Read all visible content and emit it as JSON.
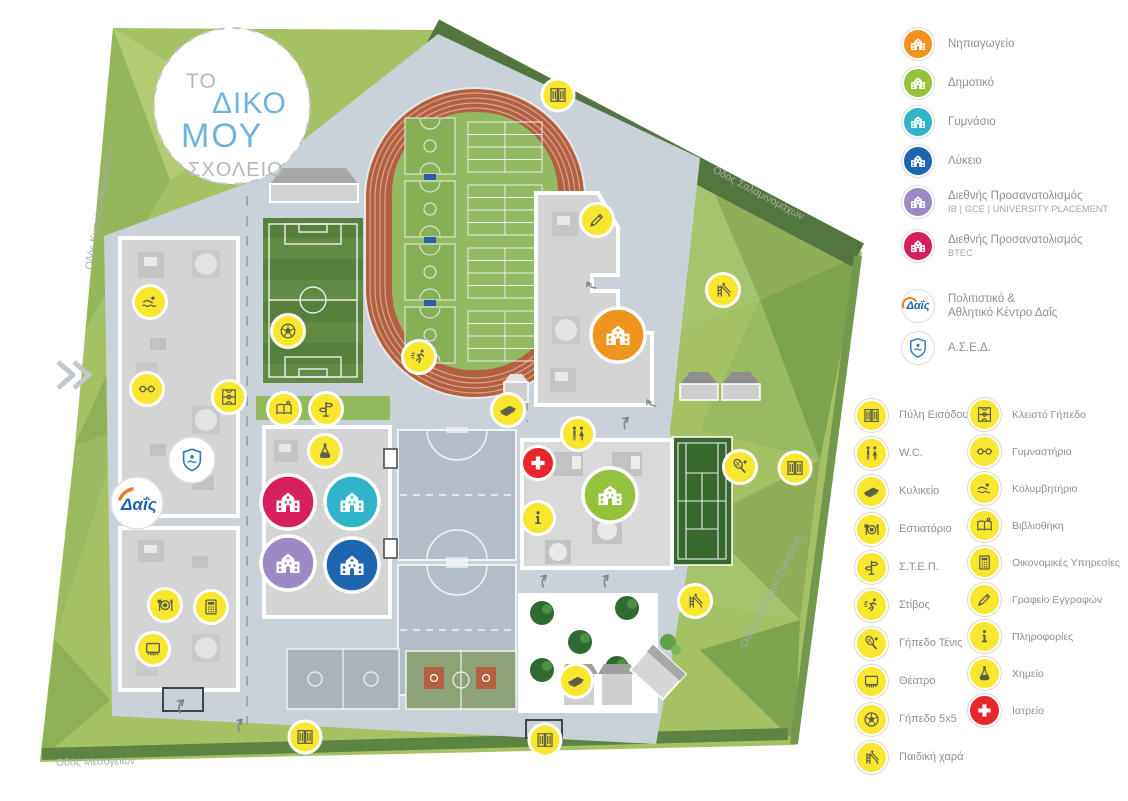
{
  "logo": {
    "word1": "ΤΟ",
    "word2": "ΔΙΚΟ",
    "word3": "ΜΟΥ",
    "word4": "ΣΧΟΛΕΙΟ"
  },
  "brand": {
    "dais": "Δαΐς"
  },
  "streets": {
    "left": "Οδός Κυπρίων Αγωνιστών",
    "top_right": "Οδός Σαλαμινομάχων",
    "right": "Οδός Ναυάρχου Σακτούρη",
    "bottom": "Οδός Μεσογείων"
  },
  "legend_schools": {
    "items": [
      {
        "label": "Νηπιαγωγείο",
        "color": "#f0941f",
        "icon": "school-building-icon"
      },
      {
        "label": "Δημοτικό",
        "color": "#96c13d",
        "icon": "school-building-icon"
      },
      {
        "label": "Γυμνάσιο",
        "color": "#2fb4c9",
        "icon": "school-building-icon"
      },
      {
        "label": "Λύκειο",
        "color": "#1d65af",
        "icon": "school-building-icon"
      },
      {
        "label": "Διεθνής Προσανατολισμός",
        "sub": "IB | GCE | UNIVERSITY PLACEMENT",
        "color": "#9c89c6",
        "icon": "school-building-icon"
      },
      {
        "label": "Διεθνής Προσανατολισμός",
        "sub": "BTEC",
        "color": "#d51f5e",
        "icon": "school-building-icon"
      }
    ],
    "extra": [
      {
        "label_line1": "Πολιτιστικό &",
        "label_line2": "Αθλητικό Κέντρο Δαΐς",
        "icon": "dais-logo"
      },
      {
        "label": "Α.Σ.Ε.Δ.",
        "icon": "ased-shield-icon"
      }
    ]
  },
  "legend_facilities": {
    "left": [
      {
        "label": "Πύλη Εισόδου",
        "icon": "door-icon"
      },
      {
        "label": "W.C.",
        "icon": "wc-icon"
      },
      {
        "label": "Κυλικείο",
        "icon": "sandwich-icon"
      },
      {
        "label": "Εστιατόριο",
        "icon": "restaurant-icon"
      },
      {
        "label": "Σ.Τ.Ε.Π.",
        "icon": "signpost-icon"
      },
      {
        "label": "Στίβος",
        "icon": "runner-icon"
      },
      {
        "label": "Γήπεδο Τένις",
        "icon": "tennis-racket-icon"
      },
      {
        "label": "Θέατρο",
        "icon": "theater-icon"
      },
      {
        "label": "Γήπεδο 5x5",
        "icon": "soccer-ball-icon"
      },
      {
        "label": "Παιδική χαρά",
        "icon": "playground-icon"
      }
    ],
    "right": [
      {
        "label": "Κλειστό Γήπεδο",
        "icon": "indoor-court-icon"
      },
      {
        "label": "Γυμναστήριο",
        "icon": "dumbbell-icon"
      },
      {
        "label": "Κολυμβητήριο",
        "icon": "swimmer-icon"
      },
      {
        "label": "Βιβλιοθήκη",
        "icon": "book-icon"
      },
      {
        "label": "Οικονομικές Υπηρεσίες",
        "icon": "calculator-icon"
      },
      {
        "label": "Γραφείο Εγγραφών",
        "icon": "pencil-icon"
      },
      {
        "label": "Πληροφορίες",
        "icon": "info-icon"
      },
      {
        "label": "Χημείο",
        "icon": "flask-icon"
      },
      {
        "label": "Ιατρείο",
        "icon": "medical-cross-icon"
      }
    ]
  },
  "colors": {
    "accent_yellow": "#f9e72f",
    "medical_red": "#e8262b",
    "paved": "#c9d1d9",
    "grass": "#a6c164",
    "forest": "#53763e",
    "track": "#b2603f",
    "pitch_green": "#57803b",
    "building_gray": "#d4d4d4",
    "logo_blue": "#6fb4de",
    "dais_blue": "#1f63ad",
    "dais_orange": "#f07c1f"
  }
}
